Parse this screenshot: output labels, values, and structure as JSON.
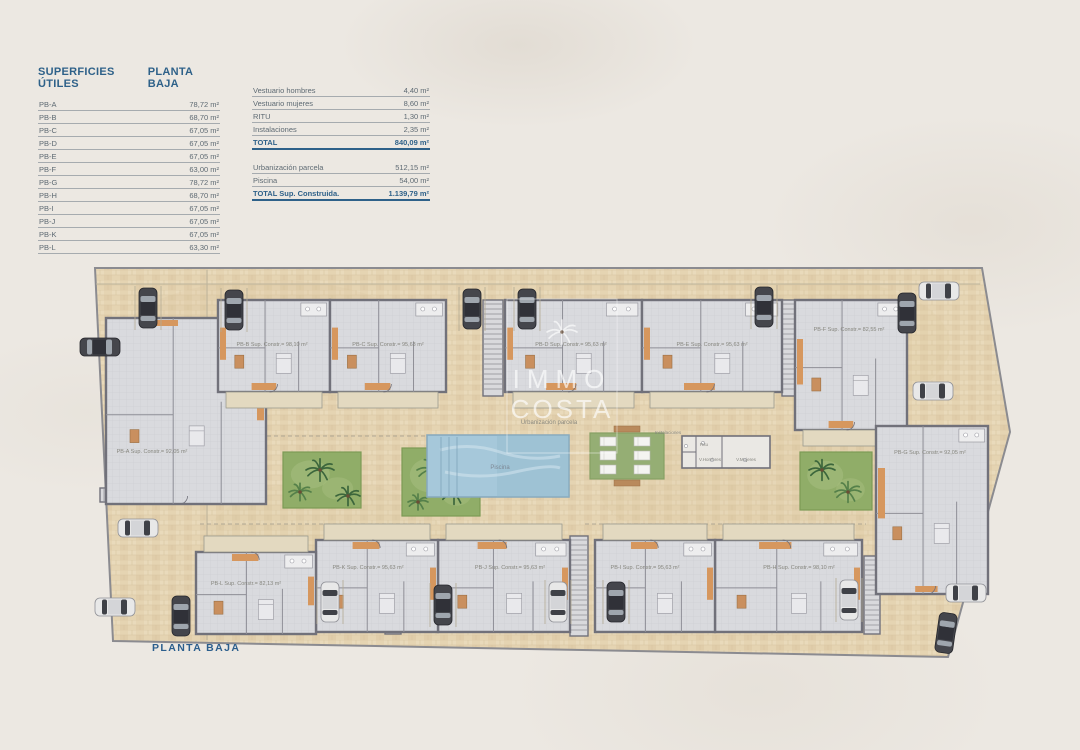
{
  "tables": {
    "superficies": {
      "title": "SUPERFICIES ÚTILES",
      "subtitle": "PLANTA BAJA",
      "rows": [
        {
          "label": "PB-A",
          "value": "78,72 m²"
        },
        {
          "label": "PB-B",
          "value": "68,70 m²"
        },
        {
          "label": "PB-C",
          "value": "67,05 m²"
        },
        {
          "label": "PB-D",
          "value": "67,05 m²"
        },
        {
          "label": "PB-E",
          "value": "67,05 m²"
        },
        {
          "label": "PB-F",
          "value": "63,00 m²"
        },
        {
          "label": "PB-G",
          "value": "78,72 m²"
        },
        {
          "label": "PB-H",
          "value": "68,70 m²"
        },
        {
          "label": "PB-I",
          "value": "67,05 m²"
        },
        {
          "label": "PB-J",
          "value": "67,05 m²"
        },
        {
          "label": "PB-K",
          "value": "67,05 m²"
        },
        {
          "label": "PB-L",
          "value": "63,30 m²"
        }
      ]
    },
    "resumen": {
      "rows": [
        {
          "label": "Vestuario hombres",
          "value": "4,40 m²"
        },
        {
          "label": "Vestuario mujeres",
          "value": "8,60 m²"
        },
        {
          "label": "RITU",
          "value": "1,30 m²"
        },
        {
          "label": "Instalaciones",
          "value": "2,35 m²"
        }
      ],
      "total": {
        "label": "TOTAL",
        "value": "840,09 m²"
      },
      "rows2": [
        {
          "label": "Urbanización parcela",
          "value": "512,15 m²"
        },
        {
          "label": "Piscina",
          "value": "54,00 m²"
        }
      ],
      "total2": {
        "label": "TOTAL Sup. Construida.",
        "value": "1.139,79 m²"
      }
    }
  },
  "plan": {
    "watermark": {
      "line1": "IMMO",
      "line2": "COSTA"
    },
    "labels": {
      "piscina": "Piscina",
      "urbanizacion": "Urbanización parcela",
      "instalaciones": "Instalaciones",
      "ritu": "Ritu",
      "vhombres": "V.Hombres",
      "vmujeres": "V.Mujeres"
    },
    "units": [
      {
        "id": "PB-A",
        "label": "PB-A Sup. Constr.= 92,05 m²",
        "x": 106,
        "y": 318,
        "w": 160,
        "h": 186,
        "lx": 152,
        "ly": 453,
        "side": "r"
      },
      {
        "id": "PB-B",
        "label": "PB-B Sup. Constr.= 98,10 m²",
        "x": 218,
        "y": 300,
        "w": 112,
        "h": 92,
        "lx": 272,
        "ly": 346,
        "side": "b"
      },
      {
        "id": "PB-C",
        "label": "PB-C Sup. Constr.= 95,63 m²",
        "x": 330,
        "y": 300,
        "w": 116,
        "h": 92,
        "lx": 388,
        "ly": 346,
        "side": "b"
      },
      {
        "id": "PB-D",
        "label": "PB-D Sup. Constr.= 95,63 m²",
        "x": 505,
        "y": 300,
        "w": 137,
        "h": 92,
        "lx": 571,
        "ly": 346,
        "side": "b"
      },
      {
        "id": "PB-E",
        "label": "PB-E Sup. Constr.= 95,63 m²",
        "x": 642,
        "y": 300,
        "w": 140,
        "h": 92,
        "lx": 712,
        "ly": 346,
        "side": "b"
      },
      {
        "id": "PB-F",
        "label": "PB-F Sup. Constr.= 82,55 m²",
        "x": 795,
        "y": 300,
        "w": 112,
        "h": 130,
        "lx": 849,
        "ly": 331,
        "side": "b"
      },
      {
        "id": "PB-G",
        "label": "PB-G Sup. Constr.= 92,05 m²",
        "x": 876,
        "y": 426,
        "w": 112,
        "h": 168,
        "lx": 930,
        "ly": 454,
        "side": "l"
      },
      {
        "id": "PB-H",
        "label": "PB-H Sup. Constr.= 98,10 m²",
        "x": 715,
        "y": 540,
        "w": 147,
        "h": 92,
        "lx": 799,
        "ly": 569,
        "side": "t"
      },
      {
        "id": "PB-I",
        "label": "PB-I Sup. Constr.= 95,63 m²",
        "x": 595,
        "y": 540,
        "w": 120,
        "h": 92,
        "lx": 645,
        "ly": 569,
        "side": "t"
      },
      {
        "id": "PB-J",
        "label": "PB-J Sup. Constr.= 95,63 m²",
        "x": 438,
        "y": 540,
        "w": 132,
        "h": 92,
        "lx": 510,
        "ly": 569,
        "side": "t"
      },
      {
        "id": "PB-K",
        "label": "PB-K Sup. Constr.= 95,63 m²",
        "x": 316,
        "y": 540,
        "w": 122,
        "h": 92,
        "lx": 368,
        "ly": 569,
        "side": "t"
      },
      {
        "id": "PB-L",
        "label": "PB-L Sup. Constr.= 82,13 m²",
        "x": 196,
        "y": 552,
        "w": 120,
        "h": 82,
        "lx": 246,
        "ly": 585,
        "side": "t"
      }
    ],
    "colors": {
      "paver": "#e5d4b2",
      "wall": "#71717a",
      "room": "#d9dade",
      "accent": "#d6975e",
      "garden": "#90ad68",
      "pool": "#a6c8da",
      "pergola": "#95ae74",
      "car_dark": "#45464c",
      "car_light": "#e8e8e8",
      "title_blue": "#2e6189"
    }
  },
  "footer": {
    "title": "PLANTA BAJA"
  }
}
